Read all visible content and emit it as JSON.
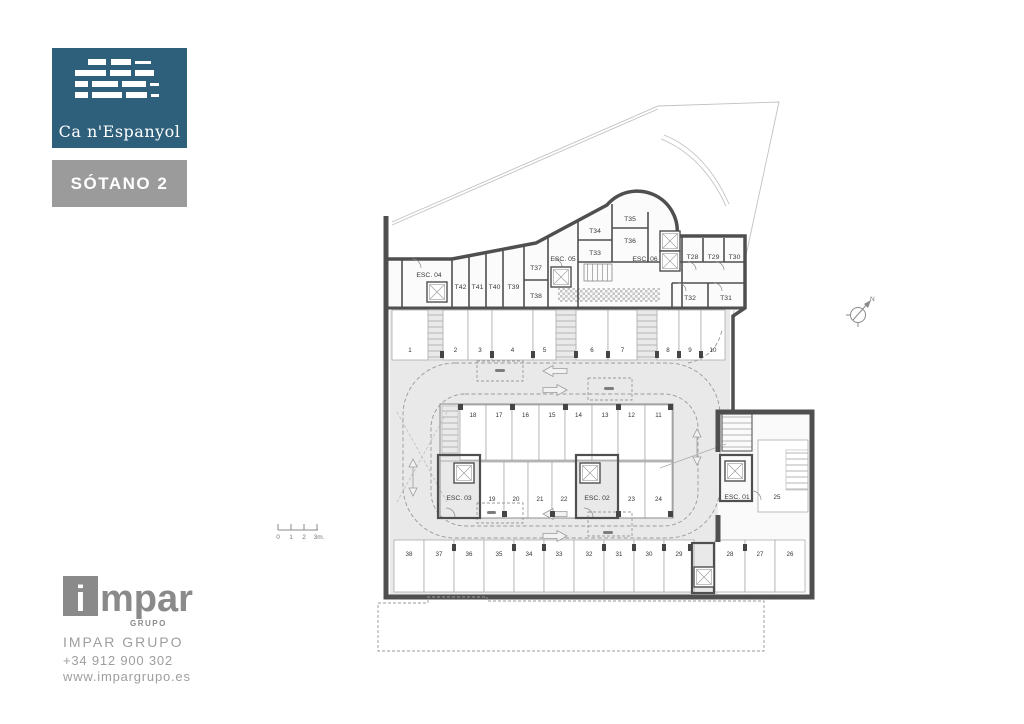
{
  "branding": {
    "project": "Ca n'Espanyol",
    "floor": "SÓTANO 2",
    "brand_color": "#2e5f7b",
    "badge_color": "#9b9b9b"
  },
  "footer": {
    "logo_i": "i",
    "logo_rest": "mpar",
    "logo_sub": "GRUPO",
    "company": "IMPAR GRUPO",
    "phone": "+34 912 900 302",
    "website": "www.impargrupo.es"
  },
  "plan": {
    "north": "N",
    "scale_ticks": [
      "0",
      "1",
      "2",
      "3m."
    ],
    "stairs": {
      "esc01": "ESC. 01",
      "esc02": "ESC. 02",
      "esc03": "ESC. 03",
      "esc04": "ESC. 04",
      "esc05": "ESC. 05",
      "esc06": "ESC. 06"
    },
    "rooms": {
      "t28": "T28",
      "t29": "T29",
      "t30": "T30",
      "t31": "T31",
      "t32": "T32",
      "t33": "T33",
      "t34": "T34",
      "t35": "T35",
      "t36": "T36",
      "t37": "T37",
      "t38": "T38",
      "t39": "T39",
      "t40": "T40",
      "t41": "T41",
      "t42": "T42"
    },
    "parking_top": [
      "1",
      "2",
      "3",
      "4",
      "5",
      "6",
      "7",
      "8",
      "9",
      "10"
    ],
    "parking_island_top": [
      "18",
      "17",
      "16",
      "15",
      "14",
      "13",
      "12",
      "11"
    ],
    "parking_island_bottom": [
      "19",
      "20",
      "21",
      "22",
      "23",
      "24"
    ],
    "parking_right": [
      "25"
    ],
    "parking_bottom": [
      "38",
      "37",
      "36",
      "35",
      "34",
      "33",
      "32",
      "31",
      "30",
      "29",
      "28",
      "27",
      "26"
    ],
    "colors": {
      "wall": "#4f4f4f",
      "aisle": "#e9e9e9",
      "dash": "#9a9a9a"
    }
  }
}
